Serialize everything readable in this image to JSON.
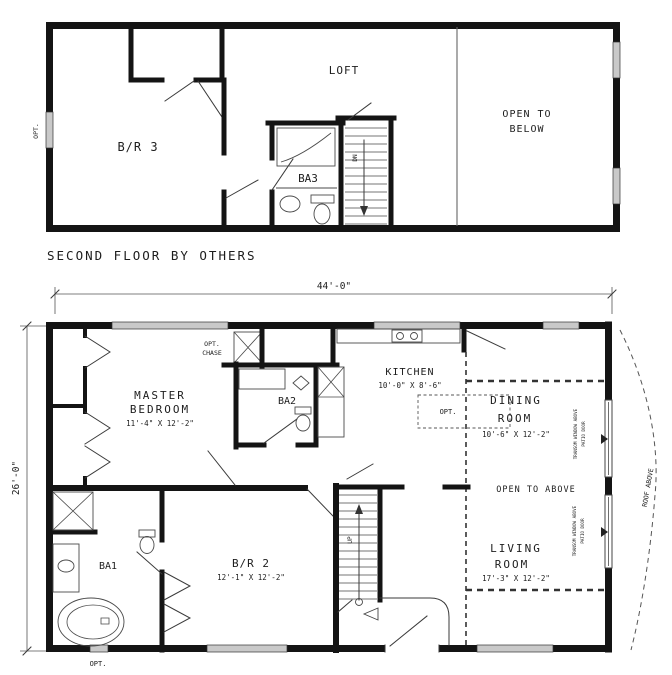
{
  "colors": {
    "wall": "#141414",
    "window_fill": "#c9c9c9",
    "thin_line": "#3a3a3a",
    "dashed_line": "#333333",
    "text": "#1d1d1d",
    "background": "#ffffff"
  },
  "dimensions": {
    "overall_width": "44'-0\"",
    "overall_depth": "26'-0\""
  },
  "second_floor": {
    "caption": "SECOND FLOOR BY OTHERS",
    "bedroom3": "B/R 3",
    "loft": "LOFT",
    "bath3": "BA3",
    "open_line1": "OPEN TO",
    "open_line2": "BELOW",
    "stair": "DN",
    "opt_window": "OPT."
  },
  "first_floor": {
    "master_line1": "MASTER",
    "master_line2": "BEDROOM",
    "master_size": "11'-4\" X 12'-2\"",
    "chase_line1": "OPT.",
    "chase_line2": "CHASE",
    "bath2": "BA2",
    "kitchen": "KITCHEN",
    "kitchen_size": "10'-0\" X 8'-6\"",
    "kitchen_opt": "OPT.",
    "dining_line1": "DINING",
    "dining_line2": "ROOM",
    "dining_size": "10'-6\" X 12'-2\"",
    "open_above": "OPEN TO ABOVE",
    "living_line1": "LIVING",
    "living_line2": "ROOM",
    "living_size": "17'-3\" X 12'-2\"",
    "bedroom2": "B/R 2",
    "bedroom2_size": "12'-1\" X 12'-2\"",
    "bath1": "BA1",
    "opt_window": "OPT.",
    "stair": "UP",
    "transom_line1": "TRANSOM WINDOW ABOVE",
    "transom_line2": "PATIO DOOR",
    "roof_note": "ROOF ABOVE"
  }
}
